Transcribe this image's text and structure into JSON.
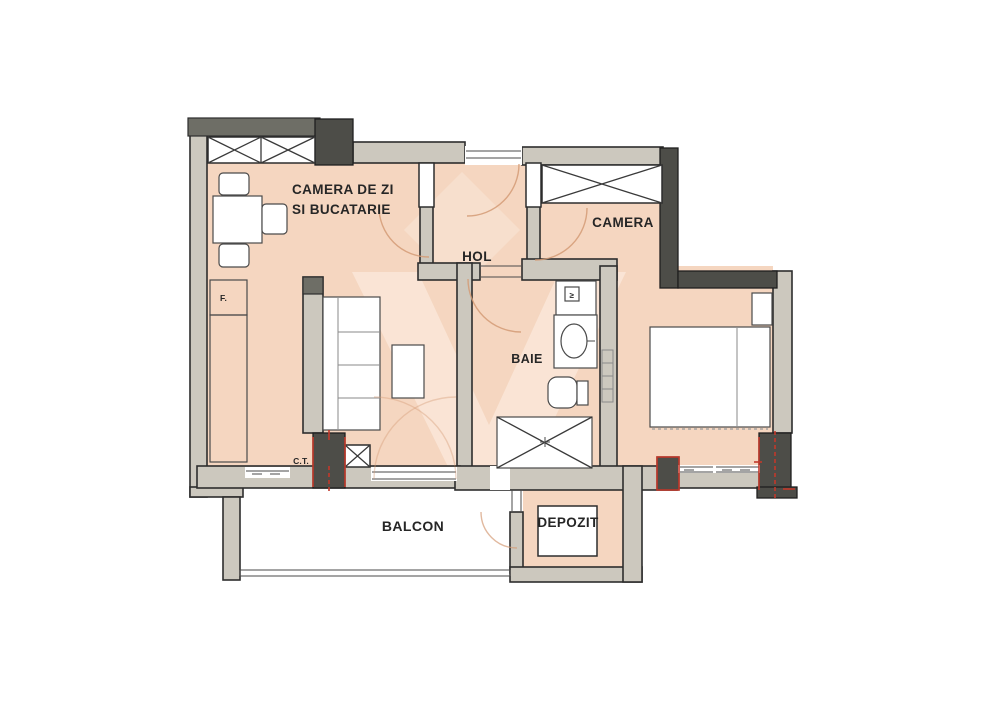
{
  "colors": {
    "room_fill": "#f5d6c0",
    "wall_fill": "#ccc8be",
    "dark_fill": "#4d4d48",
    "beam_fill": "#6e6e66",
    "red_accent": "#c2392b",
    "arc_color": "#d49b76",
    "watermark_fill": "#fdf0e6",
    "outline": "#2d2d2d"
  },
  "rooms": {
    "living_room": {
      "label_line1": "CAMERA DE ZI",
      "label_line2": "SI BUCATARIE"
    },
    "hallway": {
      "label": "HOL"
    },
    "bedroom": {
      "label": "CAMERA"
    },
    "bathroom": {
      "label": "BAIE"
    },
    "balcony": {
      "label": "BALCON"
    },
    "storage": {
      "label": "DEPOZIT"
    }
  },
  "annotations": {
    "boiler": "C.T.",
    "fridge": "F.",
    "washer_mark": "≥"
  }
}
